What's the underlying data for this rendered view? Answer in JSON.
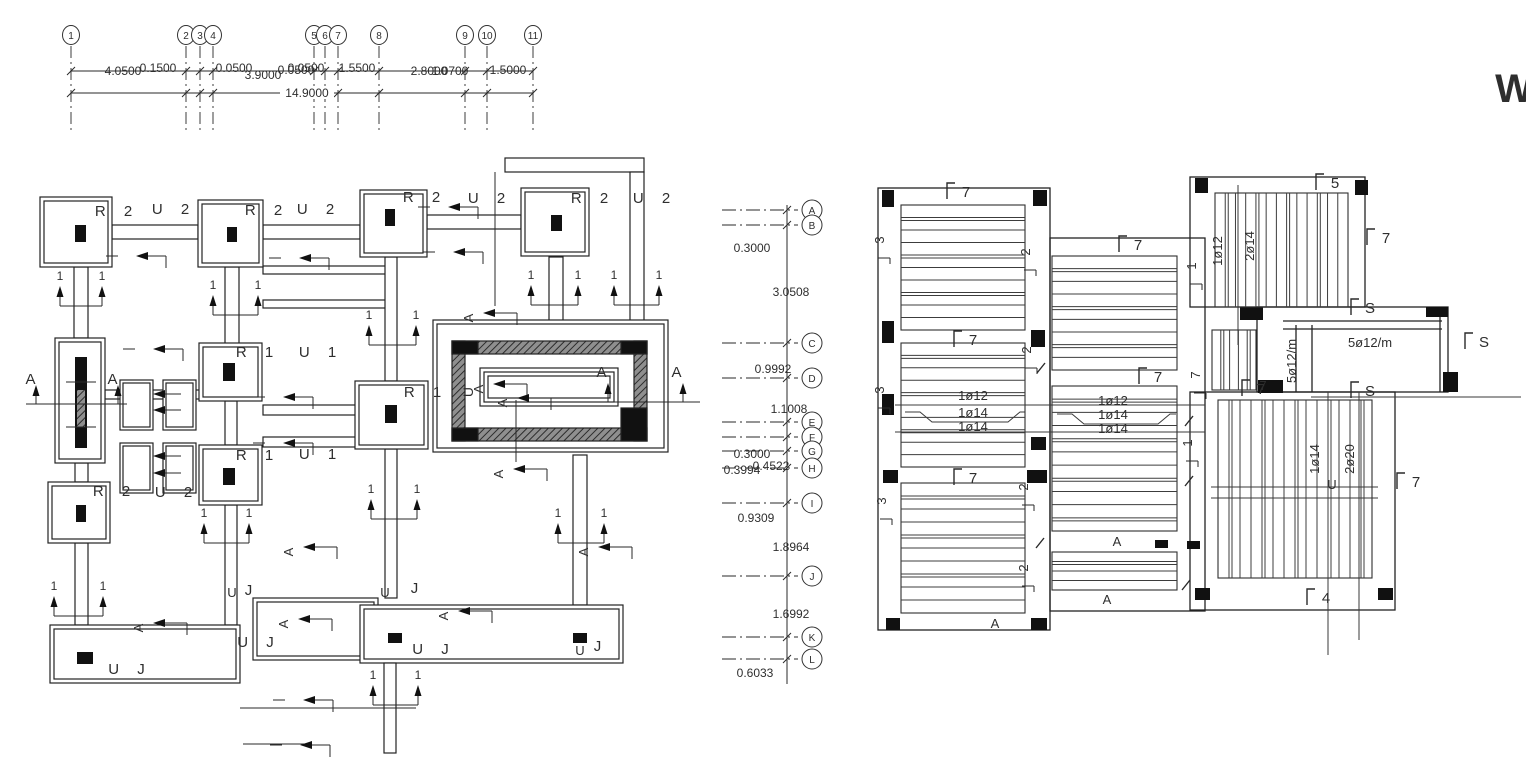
{
  "watermark": "W",
  "top_grid": {
    "bubbles": [
      {
        "l": "1",
        "x": 71
      },
      {
        "l": "2",
        "x": 186
      },
      {
        "l": "3",
        "x": 200
      },
      {
        "l": "4",
        "x": 213
      },
      {
        "l": "5",
        "x": 314
      },
      {
        "l": "6",
        "x": 325
      },
      {
        "l": "7",
        "x": 338
      },
      {
        "l": "8",
        "x": 379
      },
      {
        "l": "9",
        "x": 465
      },
      {
        "l": "10",
        "x": 487
      },
      {
        "l": "11",
        "x": 533
      }
    ],
    "dim_labels": [
      {
        "t": "4.0500",
        "x": 123,
        "y": 75
      },
      {
        "t": "0.1500",
        "x": 158,
        "y": 72
      },
      {
        "t": "0.0500",
        "x": 234,
        "y": 72
      },
      {
        "t": "3.9000",
        "x": 263,
        "y": 79
      },
      {
        "t": "0.0500",
        "x": 296,
        "y": 74
      },
      {
        "t": "0.0500",
        "x": 306,
        "y": 72
      },
      {
        "t": "1.5500",
        "x": 357,
        "y": 72
      },
      {
        "t": "2.8000",
        "x": 429,
        "y": 75
      },
      {
        "t": "1.0700",
        "x": 450,
        "y": 75
      },
      {
        "t": "1.5000",
        "x": 508,
        "y": 74
      }
    ],
    "total_label": {
      "t": "14.9000",
      "x": 307,
      "y": 97
    }
  },
  "vertical_grid": {
    "bubbles": [
      {
        "l": "A",
        "y": 210
      },
      {
        "l": "B",
        "y": 225
      },
      {
        "l": "C",
        "y": 343
      },
      {
        "l": "D",
        "y": 378
      },
      {
        "l": "E",
        "y": 422
      },
      {
        "l": "F",
        "y": 437
      },
      {
        "l": "G",
        "y": 451
      },
      {
        "l": "H",
        "y": 468
      },
      {
        "l": "I",
        "y": 503
      },
      {
        "l": "J",
        "y": 576
      },
      {
        "l": "K",
        "y": 637
      },
      {
        "l": "L",
        "y": 659
      }
    ],
    "dim_labels": [
      {
        "t": "0.3000",
        "x": 752,
        "y": 252
      },
      {
        "t": "3.0508",
        "x": 791,
        "y": 296
      },
      {
        "t": "0.9992",
        "x": 773,
        "y": 373
      },
      {
        "t": "1.1008",
        "x": 789,
        "y": 413
      },
      {
        "t": "0.3000",
        "x": 752,
        "y": 458
      },
      {
        "t": "0.4522",
        "x": 771,
        "y": 470
      },
      {
        "t": "0.3994",
        "x": 742,
        "y": 474
      },
      {
        "t": "0.9309",
        "x": 756,
        "y": 522
      },
      {
        "t": "1.8964",
        "x": 791,
        "y": 551
      },
      {
        "t": "1.6992",
        "x": 791,
        "y": 618
      },
      {
        "t": "0.6033",
        "x": 755,
        "y": 677
      }
    ]
  },
  "left_plan": {
    "labels": [
      {
        "t": "R 2",
        "x": 117,
        "y": 216
      },
      {
        "t": "U 2",
        "x": 174,
        "y": 214
      },
      {
        "t": "R 2",
        "x": 267,
        "y": 215
      },
      {
        "t": "U 2",
        "x": 319,
        "y": 214
      },
      {
        "t": "R 2",
        "x": 425,
        "y": 202
      },
      {
        "t": "U 2",
        "x": 490,
        "y": 203
      },
      {
        "t": "R 2",
        "x": 593,
        "y": 203
      },
      {
        "t": "U 2",
        "x": 655,
        "y": 203
      },
      {
        "t": "R 1",
        "x": 258,
        "y": 357
      },
      {
        "t": "U 1",
        "x": 321,
        "y": 357
      },
      {
        "t": "R 1",
        "x": 426,
        "y": 397
      },
      {
        "t": "R 1",
        "x": 258,
        "y": 460
      },
      {
        "t": "U 1",
        "x": 321,
        "y": 459
      },
      {
        "t": "R 2",
        "x": 115,
        "y": 496
      },
      {
        "t": "U 2",
        "x": 177,
        "y": 497
      },
      {
        "t": "U J",
        "x": 130,
        "y": 674
      },
      {
        "t": "U J",
        "x": 259,
        "y": 647
      },
      {
        "t": "U J",
        "x": 434,
        "y": 654
      },
      {
        "t": "J",
        "x": 601,
        "y": 651
      },
      {
        "t": "J",
        "x": 252,
        "y": 595
      },
      {
        "t": "J",
        "x": 418,
        "y": 593
      },
      {
        "t": "A",
        "x": 34,
        "y": 384
      },
      {
        "t": "A",
        "x": 116,
        "y": 384
      },
      {
        "t": "A",
        "x": 605,
        "y": 377
      },
      {
        "t": "A",
        "x": 680,
        "y": 377
      }
    ],
    "rotated": [
      {
        "t": "U",
        "x": 473,
        "y": 392
      }
    ],
    "pairs_1": [
      {
        "x1": 60,
        "x2": 102,
        "y": 280
      },
      {
        "x1": 213,
        "x2": 258,
        "y": 289
      },
      {
        "x1": 369,
        "x2": 416,
        "y": 319
      },
      {
        "x1": 531,
        "x2": 578,
        "y": 279
      },
      {
        "x1": 614,
        "x2": 659,
        "y": 279
      },
      {
        "x1": 371,
        "x2": 417,
        "y": 493
      },
      {
        "x1": 558,
        "x2": 604,
        "y": 517
      },
      {
        "x1": 204,
        "x2": 249,
        "y": 517
      },
      {
        "x1": 54,
        "x2": 103,
        "y": 590
      },
      {
        "x1": 373,
        "x2": 418,
        "y": 679
      }
    ],
    "cut_a": [
      {
        "x": 483,
        "y": 313
      },
      {
        "x": 493,
        "y": 384
      },
      {
        "x": 517,
        "y": 398
      },
      {
        "x": 513,
        "y": 469
      },
      {
        "x": 153,
        "y": 623
      },
      {
        "x": 298,
        "y": 619
      },
      {
        "x": 458,
        "y": 611
      },
      {
        "x": 303,
        "y": 547
      },
      {
        "x": 598,
        "y": 547
      }
    ],
    "cut_1": [
      {
        "x": 136,
        "y": 256
      },
      {
        "x": 299,
        "y": 258
      },
      {
        "x": 448,
        "y": 207
      },
      {
        "x": 453,
        "y": 252
      },
      {
        "x": 153,
        "y": 349
      },
      {
        "x": 283,
        "y": 397
      },
      {
        "x": 283,
        "y": 443
      },
      {
        "x": 303,
        "y": 700
      },
      {
        "x": 300,
        "y": 745
      }
    ],
    "arrows_left": [
      {
        "x": 153,
        "y": 394
      },
      {
        "x": 153,
        "y": 410
      },
      {
        "x": 153,
        "y": 456
      },
      {
        "x": 153,
        "y": 473
      }
    ],
    "up_arrows": [
      {
        "x": 36,
        "y": 404
      },
      {
        "x": 118,
        "y": 404
      },
      {
        "x": 608,
        "y": 402
      },
      {
        "x": 683,
        "y": 402
      }
    ],
    "j_markers": [
      {
        "x": 225,
        "y": 575
      },
      {
        "x": 378,
        "y": 575
      },
      {
        "x": 573,
        "y": 633
      }
    ]
  },
  "right_plan": {
    "labels": [
      {
        "t": "1ø12",
        "x": 973,
        "y": 400
      },
      {
        "t": "1ø14",
        "x": 973,
        "y": 417
      },
      {
        "t": "1ø14",
        "x": 973,
        "y": 431
      },
      {
        "t": "1ø12",
        "x": 1113,
        "y": 405
      },
      {
        "t": "1ø14",
        "x": 1113,
        "y": 419
      },
      {
        "t": "1ø14",
        "x": 1113,
        "y": 433
      },
      {
        "t": "5ø12/m",
        "x": 1370,
        "y": 347
      },
      {
        "t": "A",
        "x": 995,
        "y": 628
      },
      {
        "t": "A",
        "x": 1117,
        "y": 546
      },
      {
        "t": "A",
        "x": 1107,
        "y": 604
      },
      {
        "t": "U",
        "x": 1332,
        "y": 489
      },
      {
        "t": "7",
        "x": 1263,
        "y": 390
      }
    ],
    "rotated": [
      {
        "t": "3",
        "x": 884,
        "y": 240,
        "br": 1
      },
      {
        "t": "3",
        "x": 884,
        "y": 390,
        "br": 1
      },
      {
        "t": "3",
        "x": 886,
        "y": 501,
        "br": 1
      },
      {
        "t": "2",
        "x": 1030,
        "y": 252,
        "br": 1
      },
      {
        "t": "2",
        "x": 1031,
        "y": 350,
        "br": 1
      },
      {
        "t": "2",
        "x": 1028,
        "y": 487,
        "br": 1
      },
      {
        "t": "2",
        "x": 1028,
        "y": 568,
        "br": 1
      },
      {
        "t": "1",
        "x": 1196,
        "y": 266,
        "br": 1
      },
      {
        "t": "1",
        "x": 1192,
        "y": 443,
        "br": 1
      },
      {
        "t": "1ø12",
        "x": 1222,
        "y": 251
      },
      {
        "t": "2ø14",
        "x": 1254,
        "y": 246
      },
      {
        "t": "1ø14",
        "x": 1319,
        "y": 459
      },
      {
        "t": "2ø20",
        "x": 1354,
        "y": 459
      },
      {
        "t": "5ø12/m",
        "x": 1296,
        "y": 361
      },
      {
        "t": "7",
        "x": 1200,
        "y": 375,
        "br": 1
      }
    ],
    "brackets": [
      {
        "t": "7",
        "x": 950,
        "y": 197
      },
      {
        "t": "7",
        "x": 1122,
        "y": 250
      },
      {
        "t": "7",
        "x": 957,
        "y": 345
      },
      {
        "t": "7",
        "x": 1142,
        "y": 382
      },
      {
        "t": "7",
        "x": 957,
        "y": 483
      },
      {
        "t": "7",
        "x": 1400,
        "y": 487
      },
      {
        "t": "7",
        "x": 1370,
        "y": 243
      },
      {
        "t": "5",
        "x": 1319,
        "y": 188
      },
      {
        "t": "4",
        "x": 1310,
        "y": 603
      },
      {
        "t": "S",
        "x": 1354,
        "y": 313
      },
      {
        "t": "S",
        "x": 1468,
        "y": 347
      },
      {
        "t": "S",
        "x": 1354,
        "y": 396
      },
      {
        "t": "7",
        "x": 1245,
        "y": 394
      }
    ],
    "slashes": [
      {
        "x": 1041,
        "y": 368
      },
      {
        "x": 1040,
        "y": 543
      },
      {
        "x": 1189,
        "y": 421
      },
      {
        "x": 1189,
        "y": 481
      },
      {
        "x": 1186,
        "y": 585
      }
    ],
    "panels": [
      {
        "x": 901,
        "y": 205,
        "w": 124,
        "h": 125,
        "o": "h",
        "n": 9
      },
      {
        "x": 901,
        "y": 343,
        "w": 124,
        "h": 124,
        "o": "h",
        "n": 9
      },
      {
        "x": 901,
        "y": 483,
        "w": 124,
        "h": 130,
        "o": "h",
        "n": 9
      },
      {
        "x": 1052,
        "y": 256,
        "w": 125,
        "h": 114,
        "o": "h",
        "n": 8
      },
      {
        "x": 1052,
        "y": 386,
        "w": 125,
        "h": 145,
        "o": "h",
        "n": 10
      },
      {
        "x": 1052,
        "y": 552,
        "w": 125,
        "h": 38,
        "o": "h",
        "n": 3
      },
      {
        "x": 1215,
        "y": 193,
        "w": 133,
        "h": 114,
        "o": "v",
        "n": 12
      },
      {
        "x": 1218,
        "y": 400,
        "w": 154,
        "h": 178,
        "o": "v",
        "n": 13
      },
      {
        "x": 1212,
        "y": 330,
        "w": 44,
        "h": 60,
        "o": "v",
        "n": 4
      }
    ]
  }
}
